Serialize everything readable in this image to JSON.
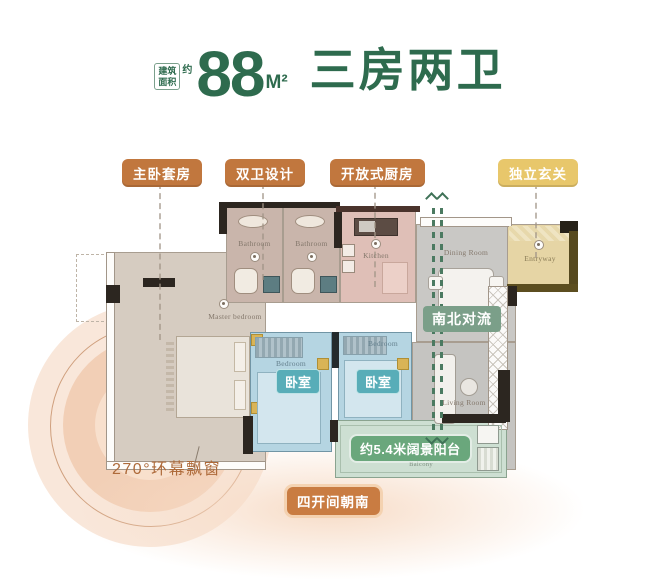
{
  "title": {
    "area_box_top": "建筑",
    "area_box_bottom": "面积",
    "area_approx": "约",
    "value": "88",
    "unit": "M²",
    "headline": "三房两卫"
  },
  "callouts": [
    {
      "label": "主卧套房"
    },
    {
      "label": "双卫设计"
    },
    {
      "label": "开放式厨房"
    },
    {
      "label": "独立玄关"
    }
  ],
  "plan": {
    "rooms": {
      "master": {
        "label": "Master bedroom"
      },
      "bathroom1": {
        "label": "Bathroom"
      },
      "bathroom2": {
        "label": "Bathroom"
      },
      "kitchen": {
        "label": "Kitchen"
      },
      "dining": {
        "label": "Dining Room"
      },
      "entryway": {
        "label": "Entryway"
      },
      "bedroom1": {
        "label": "Bedroom",
        "badge": "卧室"
      },
      "bedroom2": {
        "label": "Bedroom",
        "badge": "卧室"
      },
      "living": {
        "label": "Living Room"
      },
      "balcony": {
        "label": "Balcony"
      }
    },
    "airflow_badge": "南北对流",
    "balcony_badge": "约5.4米阔景阳台"
  },
  "annotations": {
    "bay_window": "270°环幕飘窗",
    "south_facing": "四开间朝南"
  },
  "colors": {
    "brand_green": "#2e6b4e",
    "callout_orange": "#c1773e",
    "callout_yellow": "#e8c76b",
    "flow_green": "#7b9f89",
    "balcony_green": "#6aa77c",
    "bedroom_teal": "#58adb8"
  }
}
